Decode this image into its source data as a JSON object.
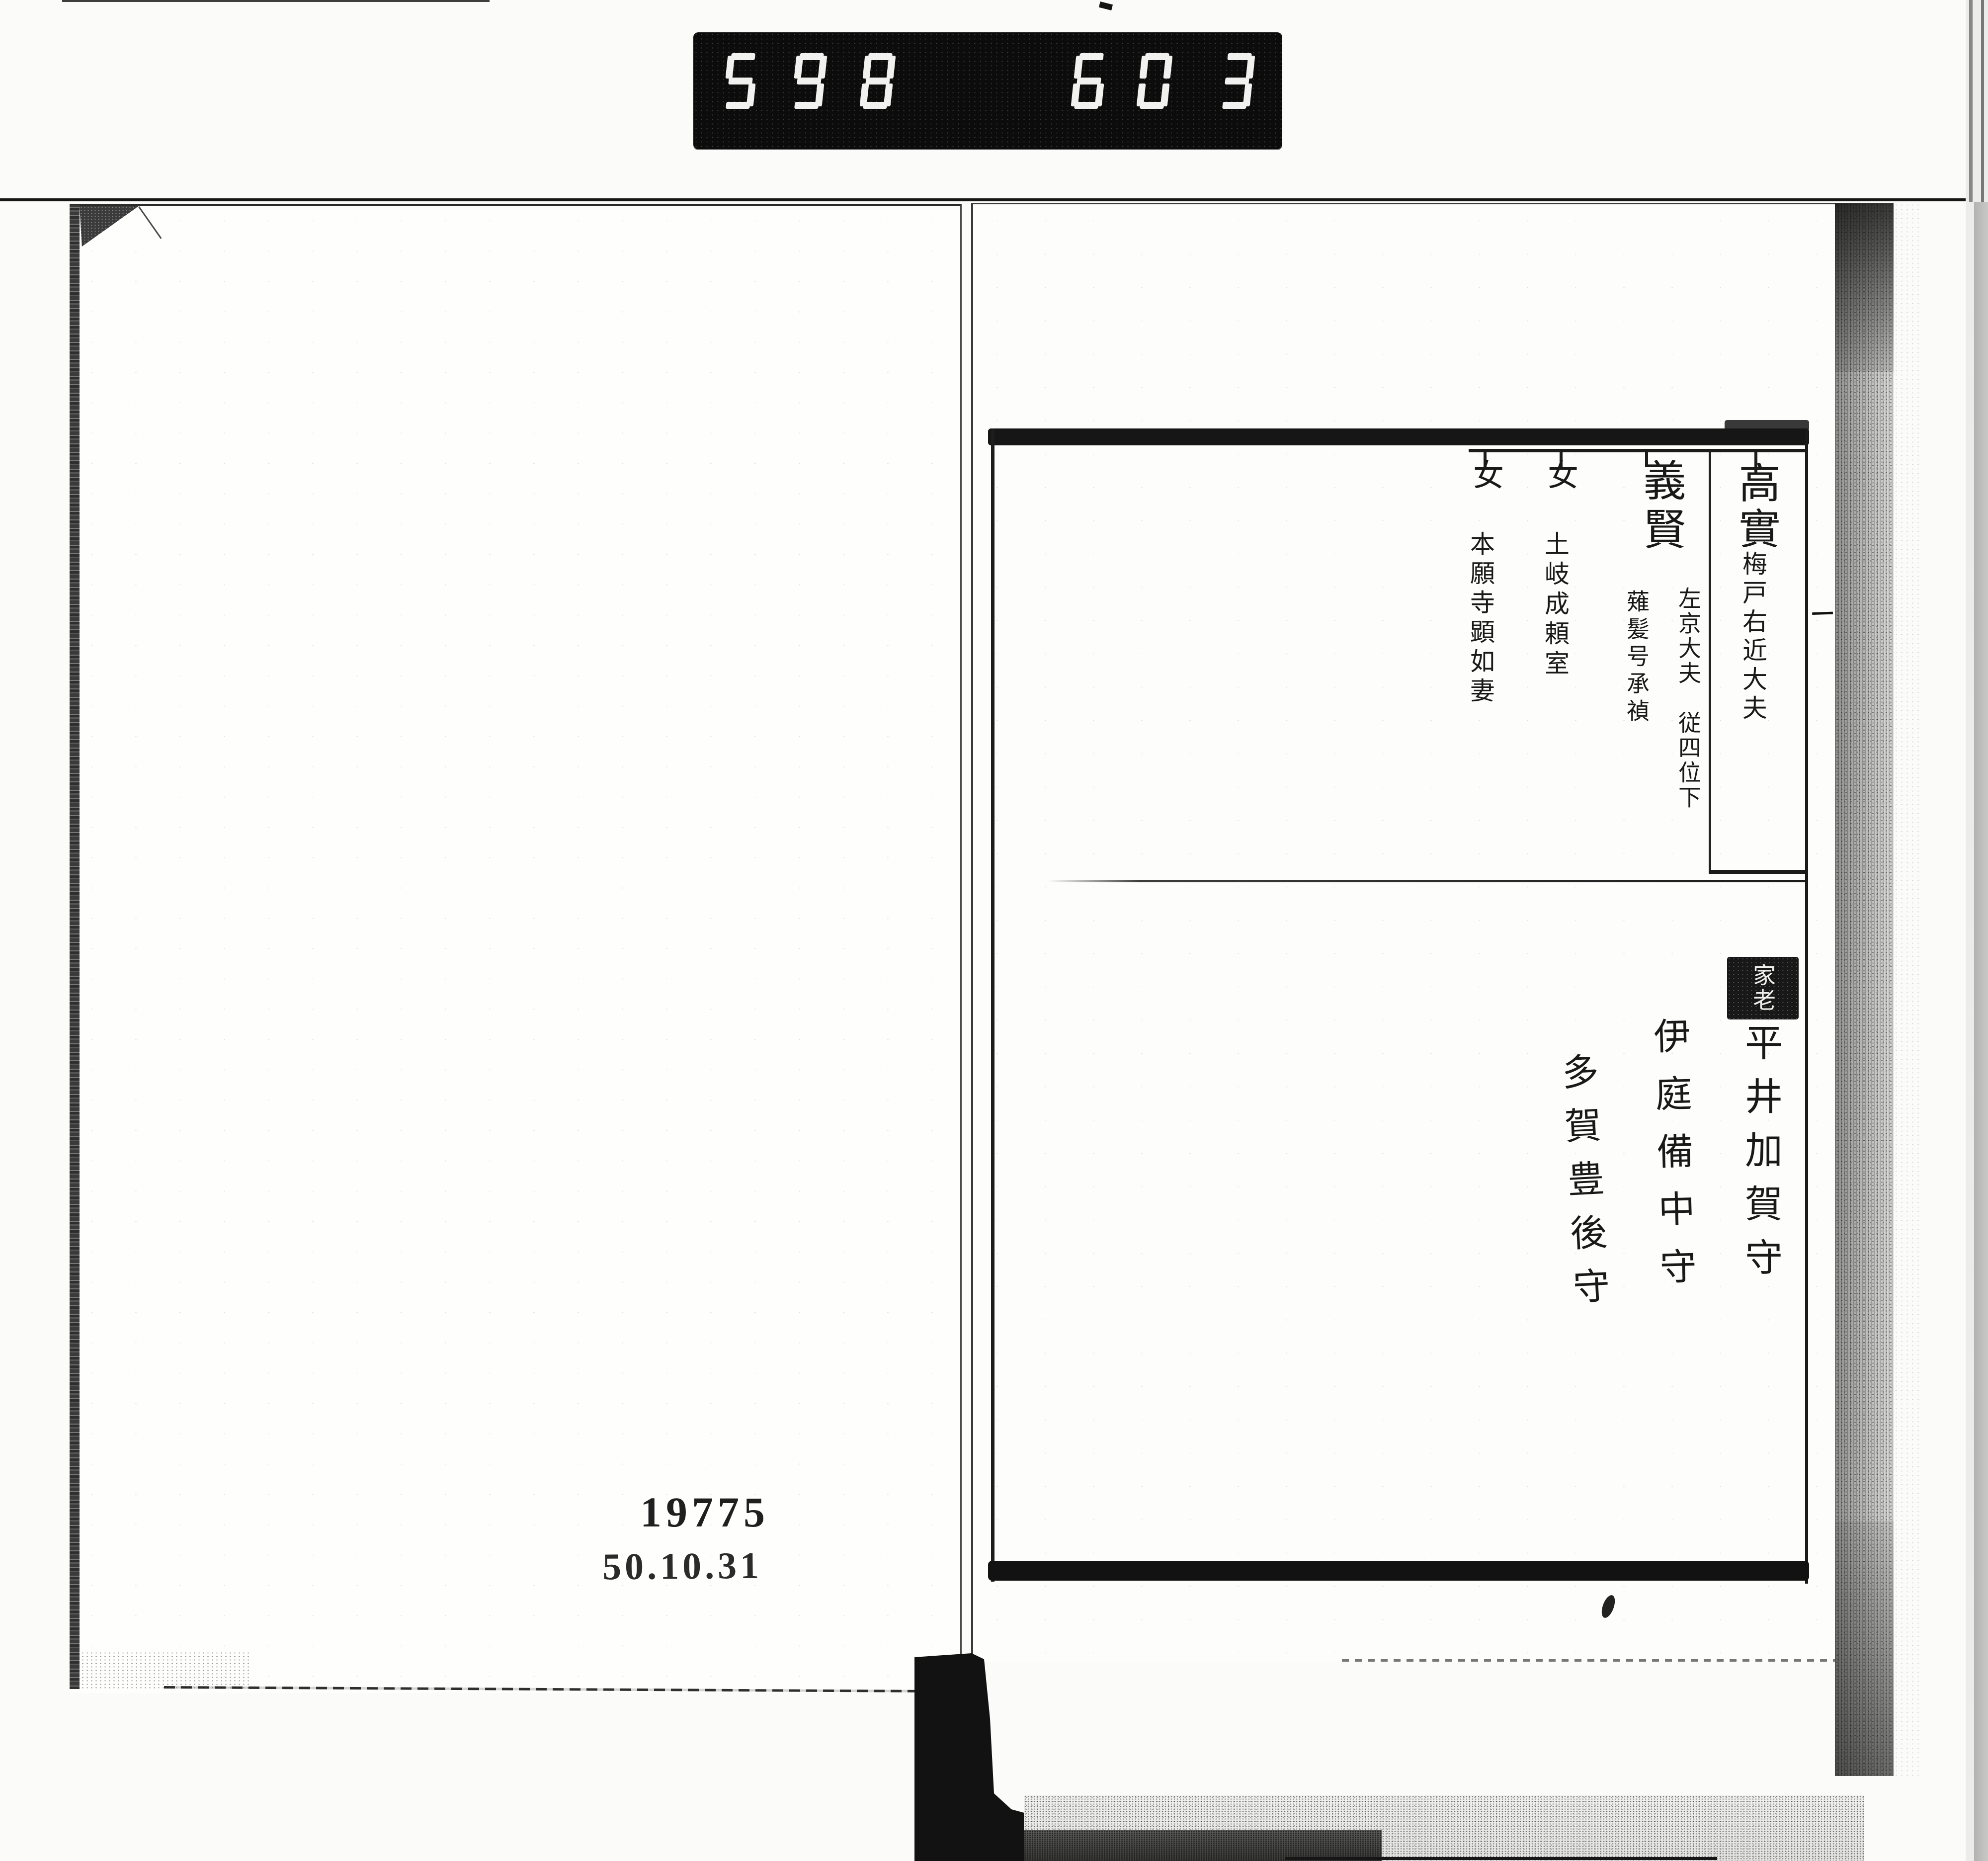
{
  "scanner_counter": {
    "left_digits": "598",
    "right_digits": "603"
  },
  "left_page": {
    "accession_number": "19775",
    "date_stamp": "50.10.31"
  },
  "right_page": {
    "genealogy_children": [
      {
        "name": "高實",
        "title_note": "梅戸右近大夫"
      },
      {
        "name": "義賢",
        "rank_note": "左京大夫　従四位下",
        "tonsure_note": "薙髪号承禎"
      },
      {
        "name": "女",
        "marriage_note": "土岐成頼室"
      },
      {
        "name": "女",
        "marriage_note": "本願寺顕如妻"
      }
    ],
    "retainer_section": {
      "seal_label": "家老",
      "retainers": [
        "平井加賀守",
        "伊庭備中守",
        "多賀豊後守"
      ]
    },
    "page_edge_mark": "一",
    "binding_mark": "十"
  }
}
